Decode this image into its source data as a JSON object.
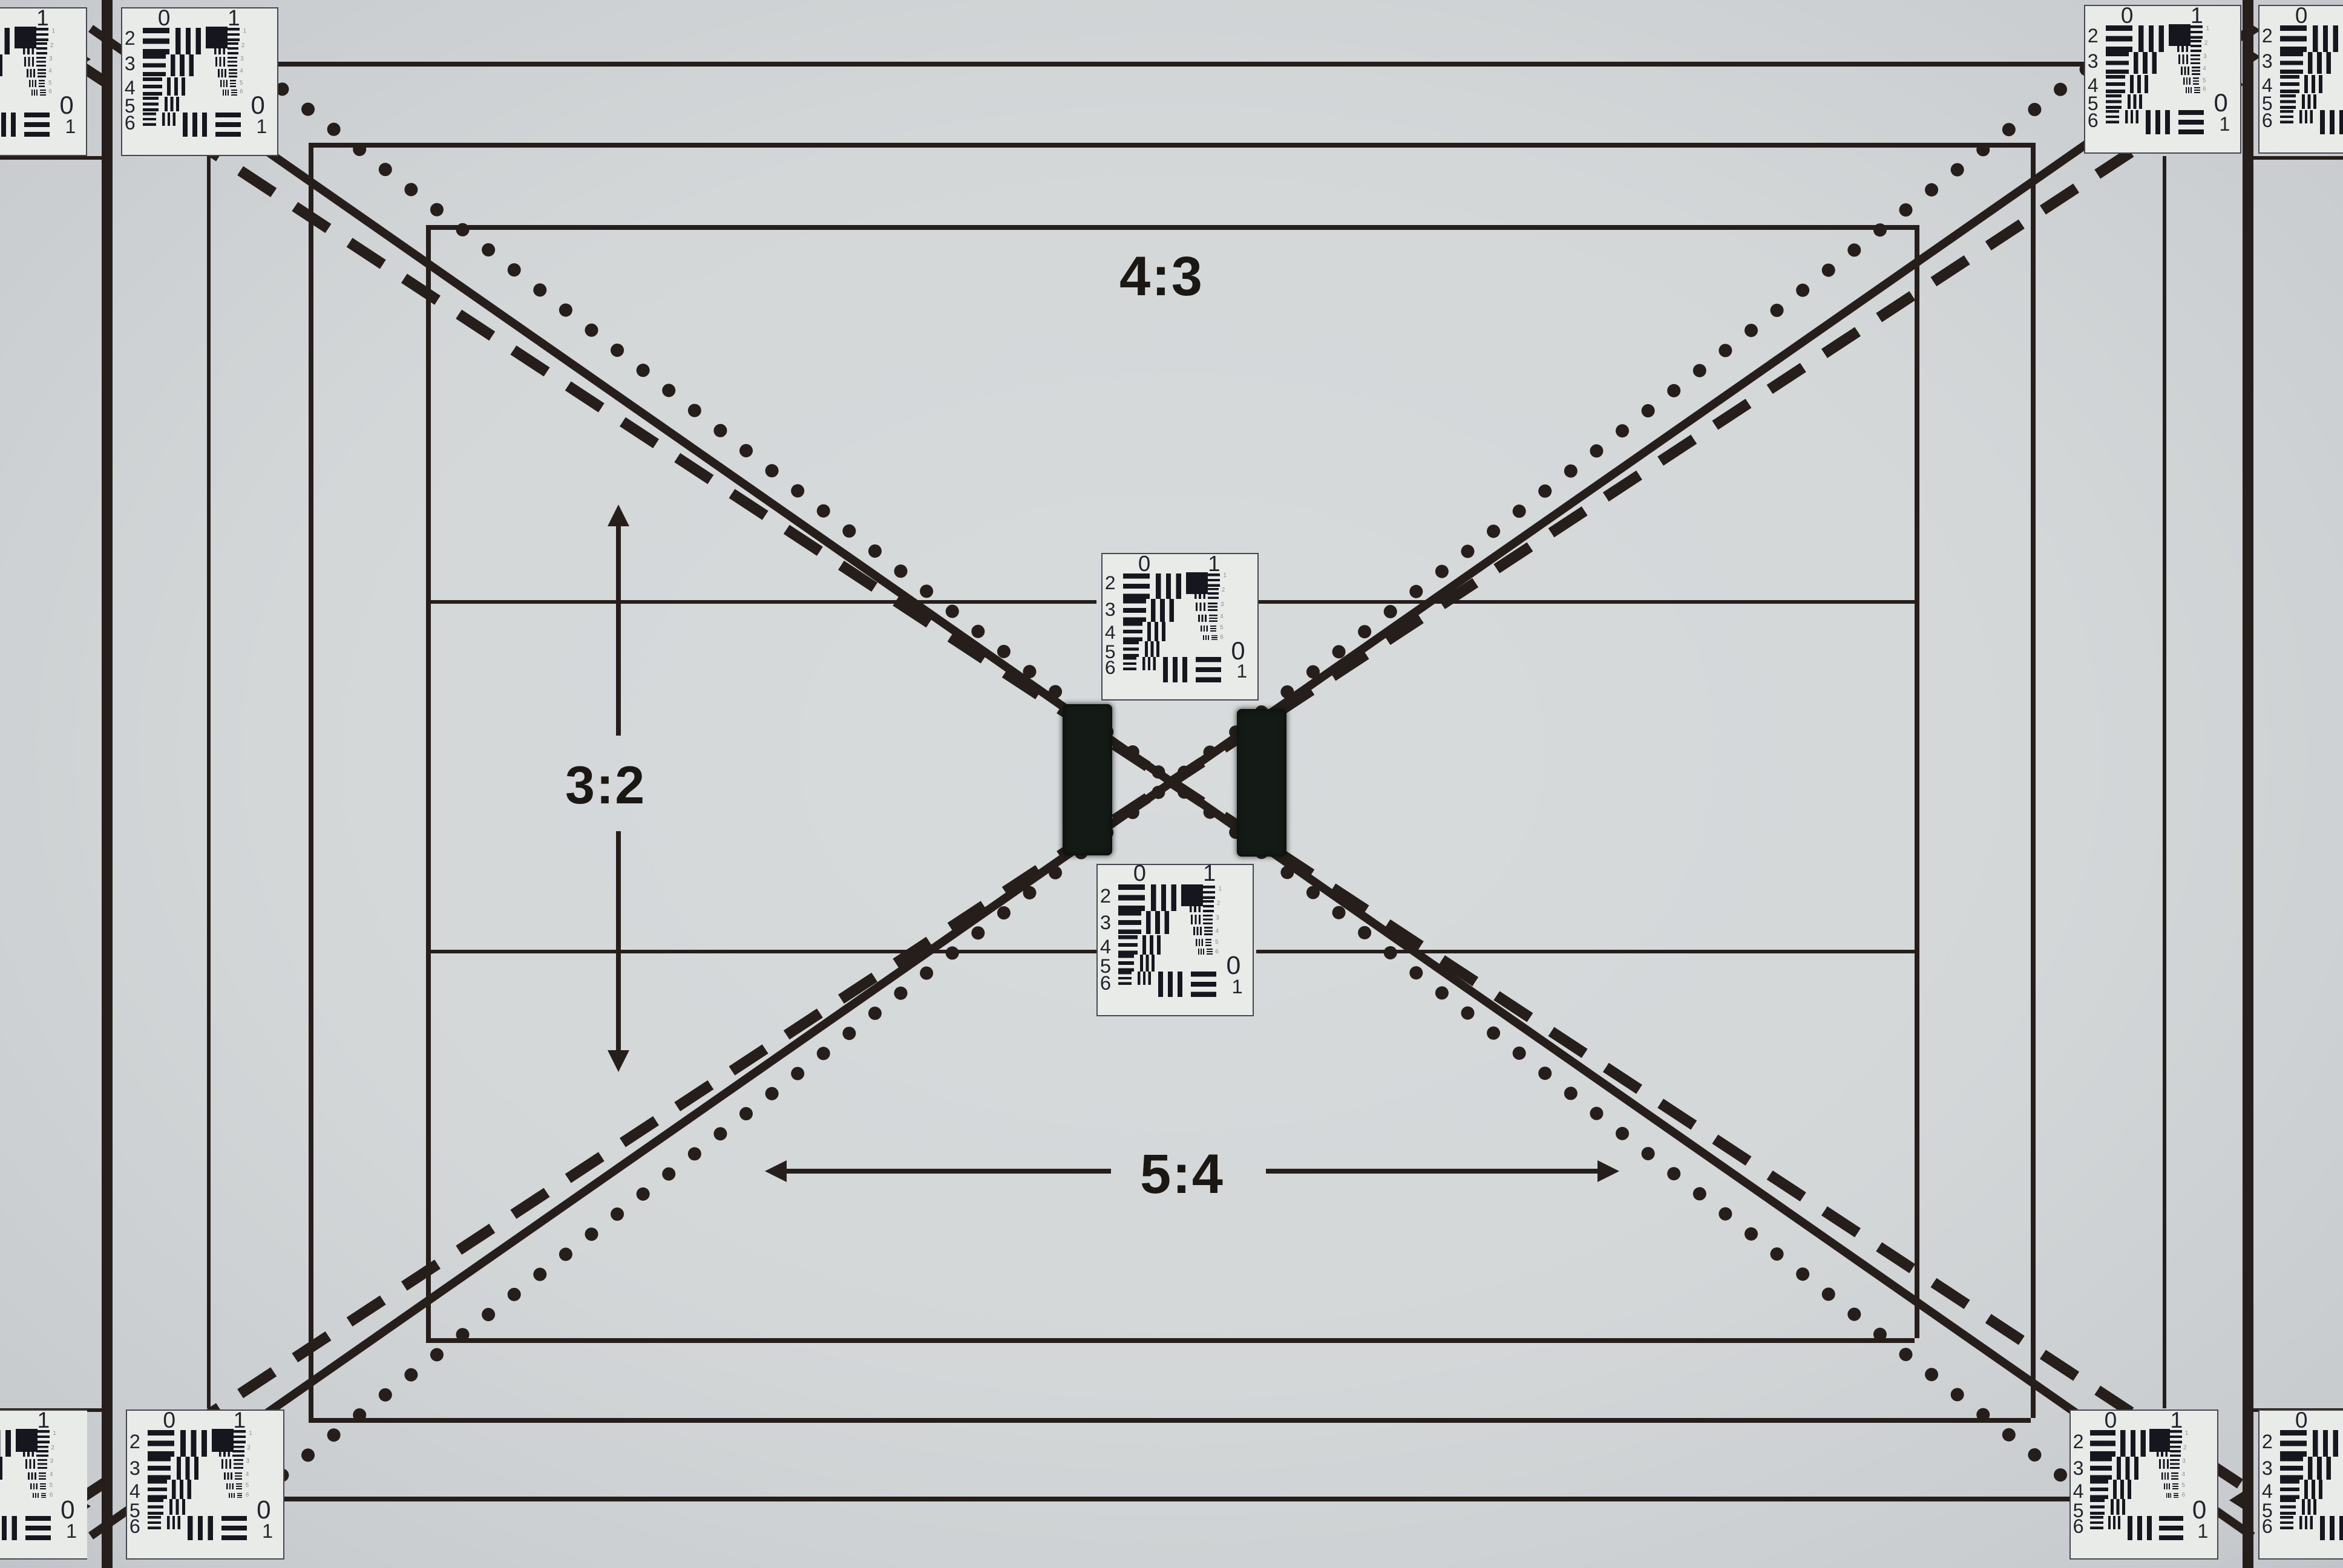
{
  "labels": {
    "top_aspect": "4:3",
    "left_aspect": "3:2",
    "bottom_aspect": "5:4"
  },
  "usaf_target": {
    "top_groups": [
      "0",
      "1"
    ],
    "row_numbers": [
      "2",
      "3",
      "4",
      "5",
      "6"
    ],
    "mini_indices": [
      "1",
      "2",
      "3",
      "4",
      "5",
      "6"
    ],
    "corner_groups": [
      "0",
      "1"
    ]
  },
  "targets": {
    "full_positions": [
      "top-left",
      "top-right",
      "bottom-left",
      "bottom-right",
      "center-upper",
      "center-lower"
    ],
    "partial_positions": [
      "left-edge-top",
      "left-edge-bottom",
      "right-edge-top",
      "right-edge-bottom"
    ]
  },
  "colors": {
    "background": "#d3d7d8",
    "edge_shade": "#c6cacd",
    "line_ink": "#251e1a",
    "target_ink": "#16161f",
    "target_bg": "#e9ebe8",
    "target_border": "#474752",
    "velcro_black": "#141b16",
    "label_ink": "#1b1713"
  }
}
